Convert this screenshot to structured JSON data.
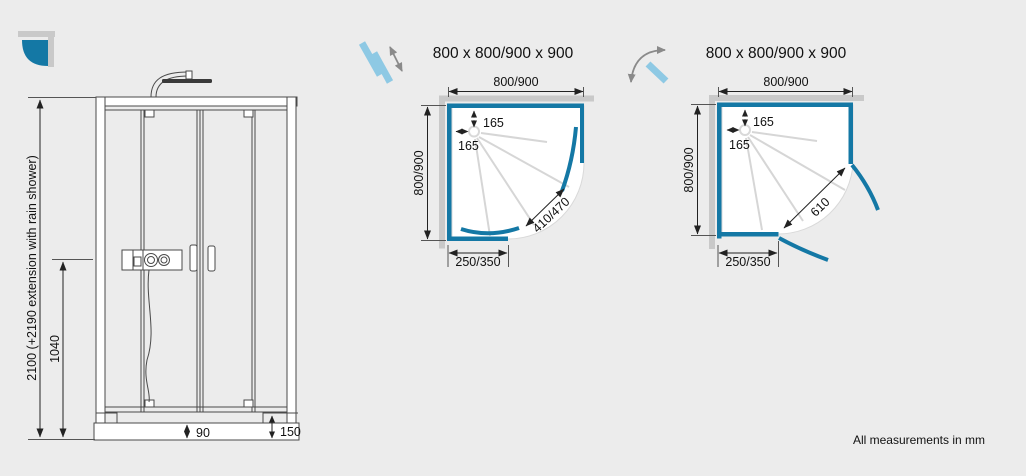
{
  "footer": {
    "note": "All measurements in mm"
  },
  "colors": {
    "accent_blue": "#1478a5",
    "light_blue": "#8ec9e4",
    "wall_gray": "#c9c9c9",
    "background": "#ececec",
    "dimension_line": "#222222",
    "drawing_line": "#4a4a4a"
  },
  "logo": {
    "icon": "quadrant-shower-logo"
  },
  "elevation": {
    "dim_total_height": "2100 (+2190 extension with rain shower)",
    "dim_valve_height": "1040",
    "dim_tray_inner": "90",
    "dim_tray_height": "150"
  },
  "plans": {
    "sliding": {
      "icon": "sliding-door-icon",
      "title": "800 x 800/900 x 900",
      "dim_width": "800/900",
      "dim_depth": "800/900",
      "dim_drain_from_back": "165",
      "dim_drain_from_side": "165",
      "dim_door_opening": "410/470",
      "dim_side_panel": "250/350"
    },
    "pivot": {
      "icon": "pivot-door-icon",
      "title": "800 x 800/900 x 900",
      "dim_width": "800/900",
      "dim_depth": "800/900",
      "dim_drain_from_back": "165",
      "dim_drain_from_side": "165",
      "dim_door_opening": "610",
      "dim_side_panel": "250/350"
    }
  }
}
